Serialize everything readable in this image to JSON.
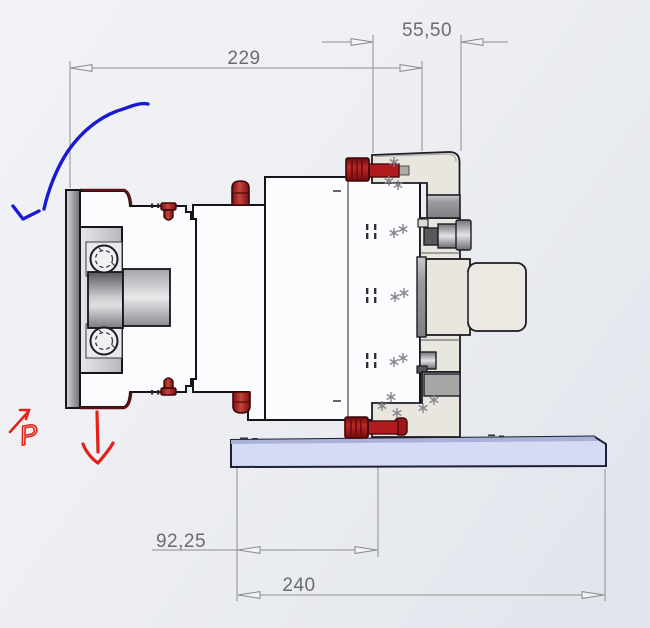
{
  "viewport": {
    "type": "cad-side-view-drawing",
    "dimensions": {
      "overall_length": "229",
      "top_offset": "55,50",
      "base_front_offset": "92,25",
      "base_plate_length": "240"
    },
    "ink_annotations": {
      "p_label": "P",
      "blue_arrow": "counter-clockwise-rotation-arrow",
      "red_arrow": "downward-force-arrow"
    },
    "colors": {
      "outline": "#15151d",
      "body_fill": "#fbfcfe",
      "bracket_beige": "#e9e6df",
      "metal_gray": "#9c9da0",
      "fastener_red": "#a91619",
      "base_plate_lavender": "#d5dbf4",
      "dimension_gray": "#8f8f8f",
      "ink_blue": "#1a1ad0",
      "ink_red": "#e32119"
    }
  }
}
